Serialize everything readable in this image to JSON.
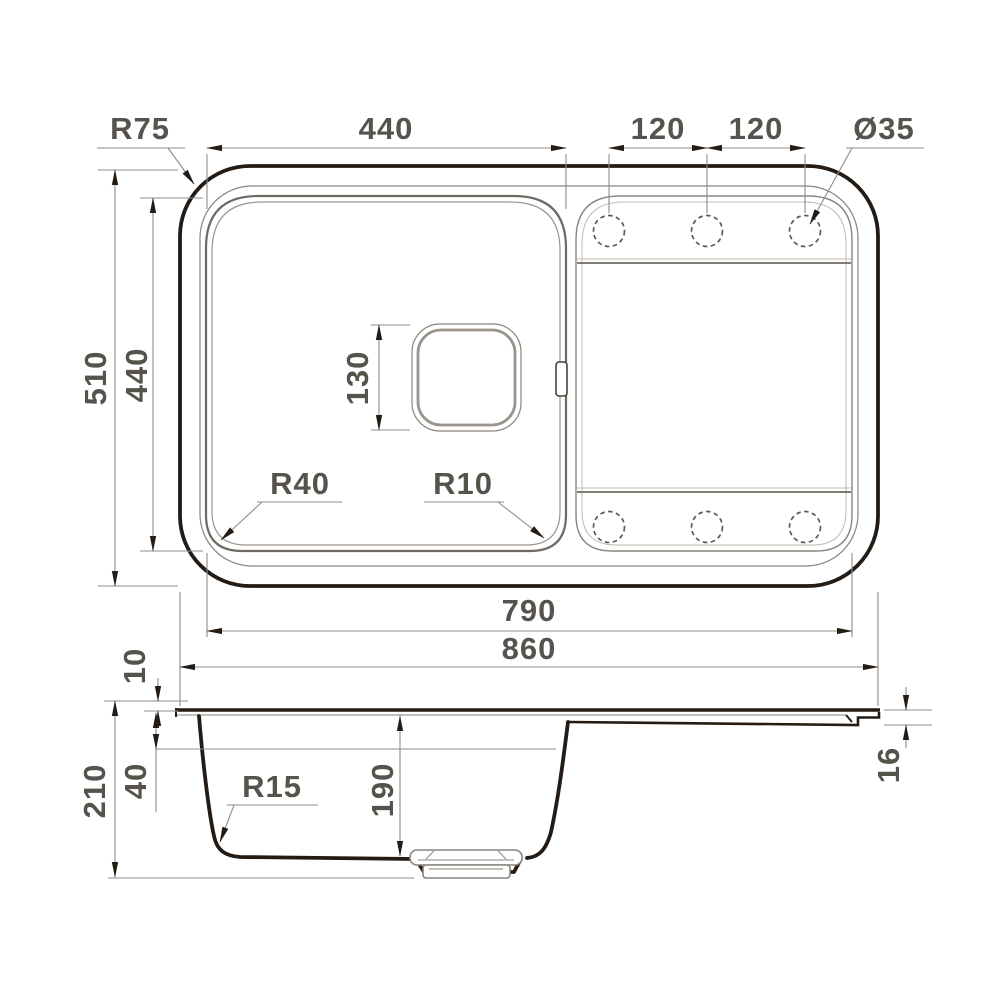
{
  "colors": {
    "outline_dark": "#241c14",
    "secondary_line": "#6f6962",
    "rim_line": "#8a847c",
    "light_line": "#c0bab2",
    "dimension_line": "#8d8d8d",
    "label_text": "#56524c",
    "background": "#ffffff"
  },
  "top_view": {
    "faucet_hole_count": 6,
    "labels": {
      "corner_radius": "R75",
      "bowl_width": "440",
      "hole_pitch_1": "120",
      "hole_pitch_2": "120",
      "hole_diameter": "Ø35",
      "overall_depth": "510",
      "bowl_depth": "440",
      "drain_square_size": "130",
      "bowl_corner_radius_left": "R40",
      "bowl_corner_radius_right": "R10",
      "inner_length": "790",
      "overall_length": "860"
    }
  },
  "side_view": {
    "labels": {
      "rim_height": "10",
      "overall_height": "210",
      "upper_depth": "40",
      "bottom_corner_radius": "R15",
      "bowl_depth": "190",
      "edge_thickness": "16"
    }
  }
}
